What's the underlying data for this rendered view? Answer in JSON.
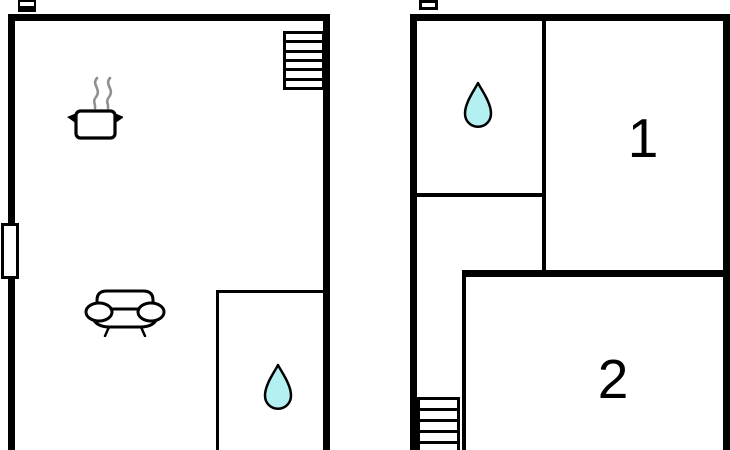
{
  "colors": {
    "background": "#ffffff",
    "wall": "#000000",
    "drop_fill": "#b4f0f2",
    "steam": "#8f8f8f",
    "label": "#000000"
  },
  "plans": {
    "left": {
      "name": "left-floor-plan",
      "icons": [
        "entrance-marker-icon",
        "staircase-icon",
        "cooking-pot-icon",
        "window-icon",
        "sofa-icon",
        "water-drop-icon"
      ]
    },
    "right": {
      "name": "right-floor-plan",
      "icons": [
        "window-marker-icon",
        "water-drop-icon",
        "staircase-icon"
      ],
      "rooms": [
        {
          "id": "room-1",
          "label": "1"
        },
        {
          "id": "room-2",
          "label": "2"
        }
      ]
    }
  }
}
